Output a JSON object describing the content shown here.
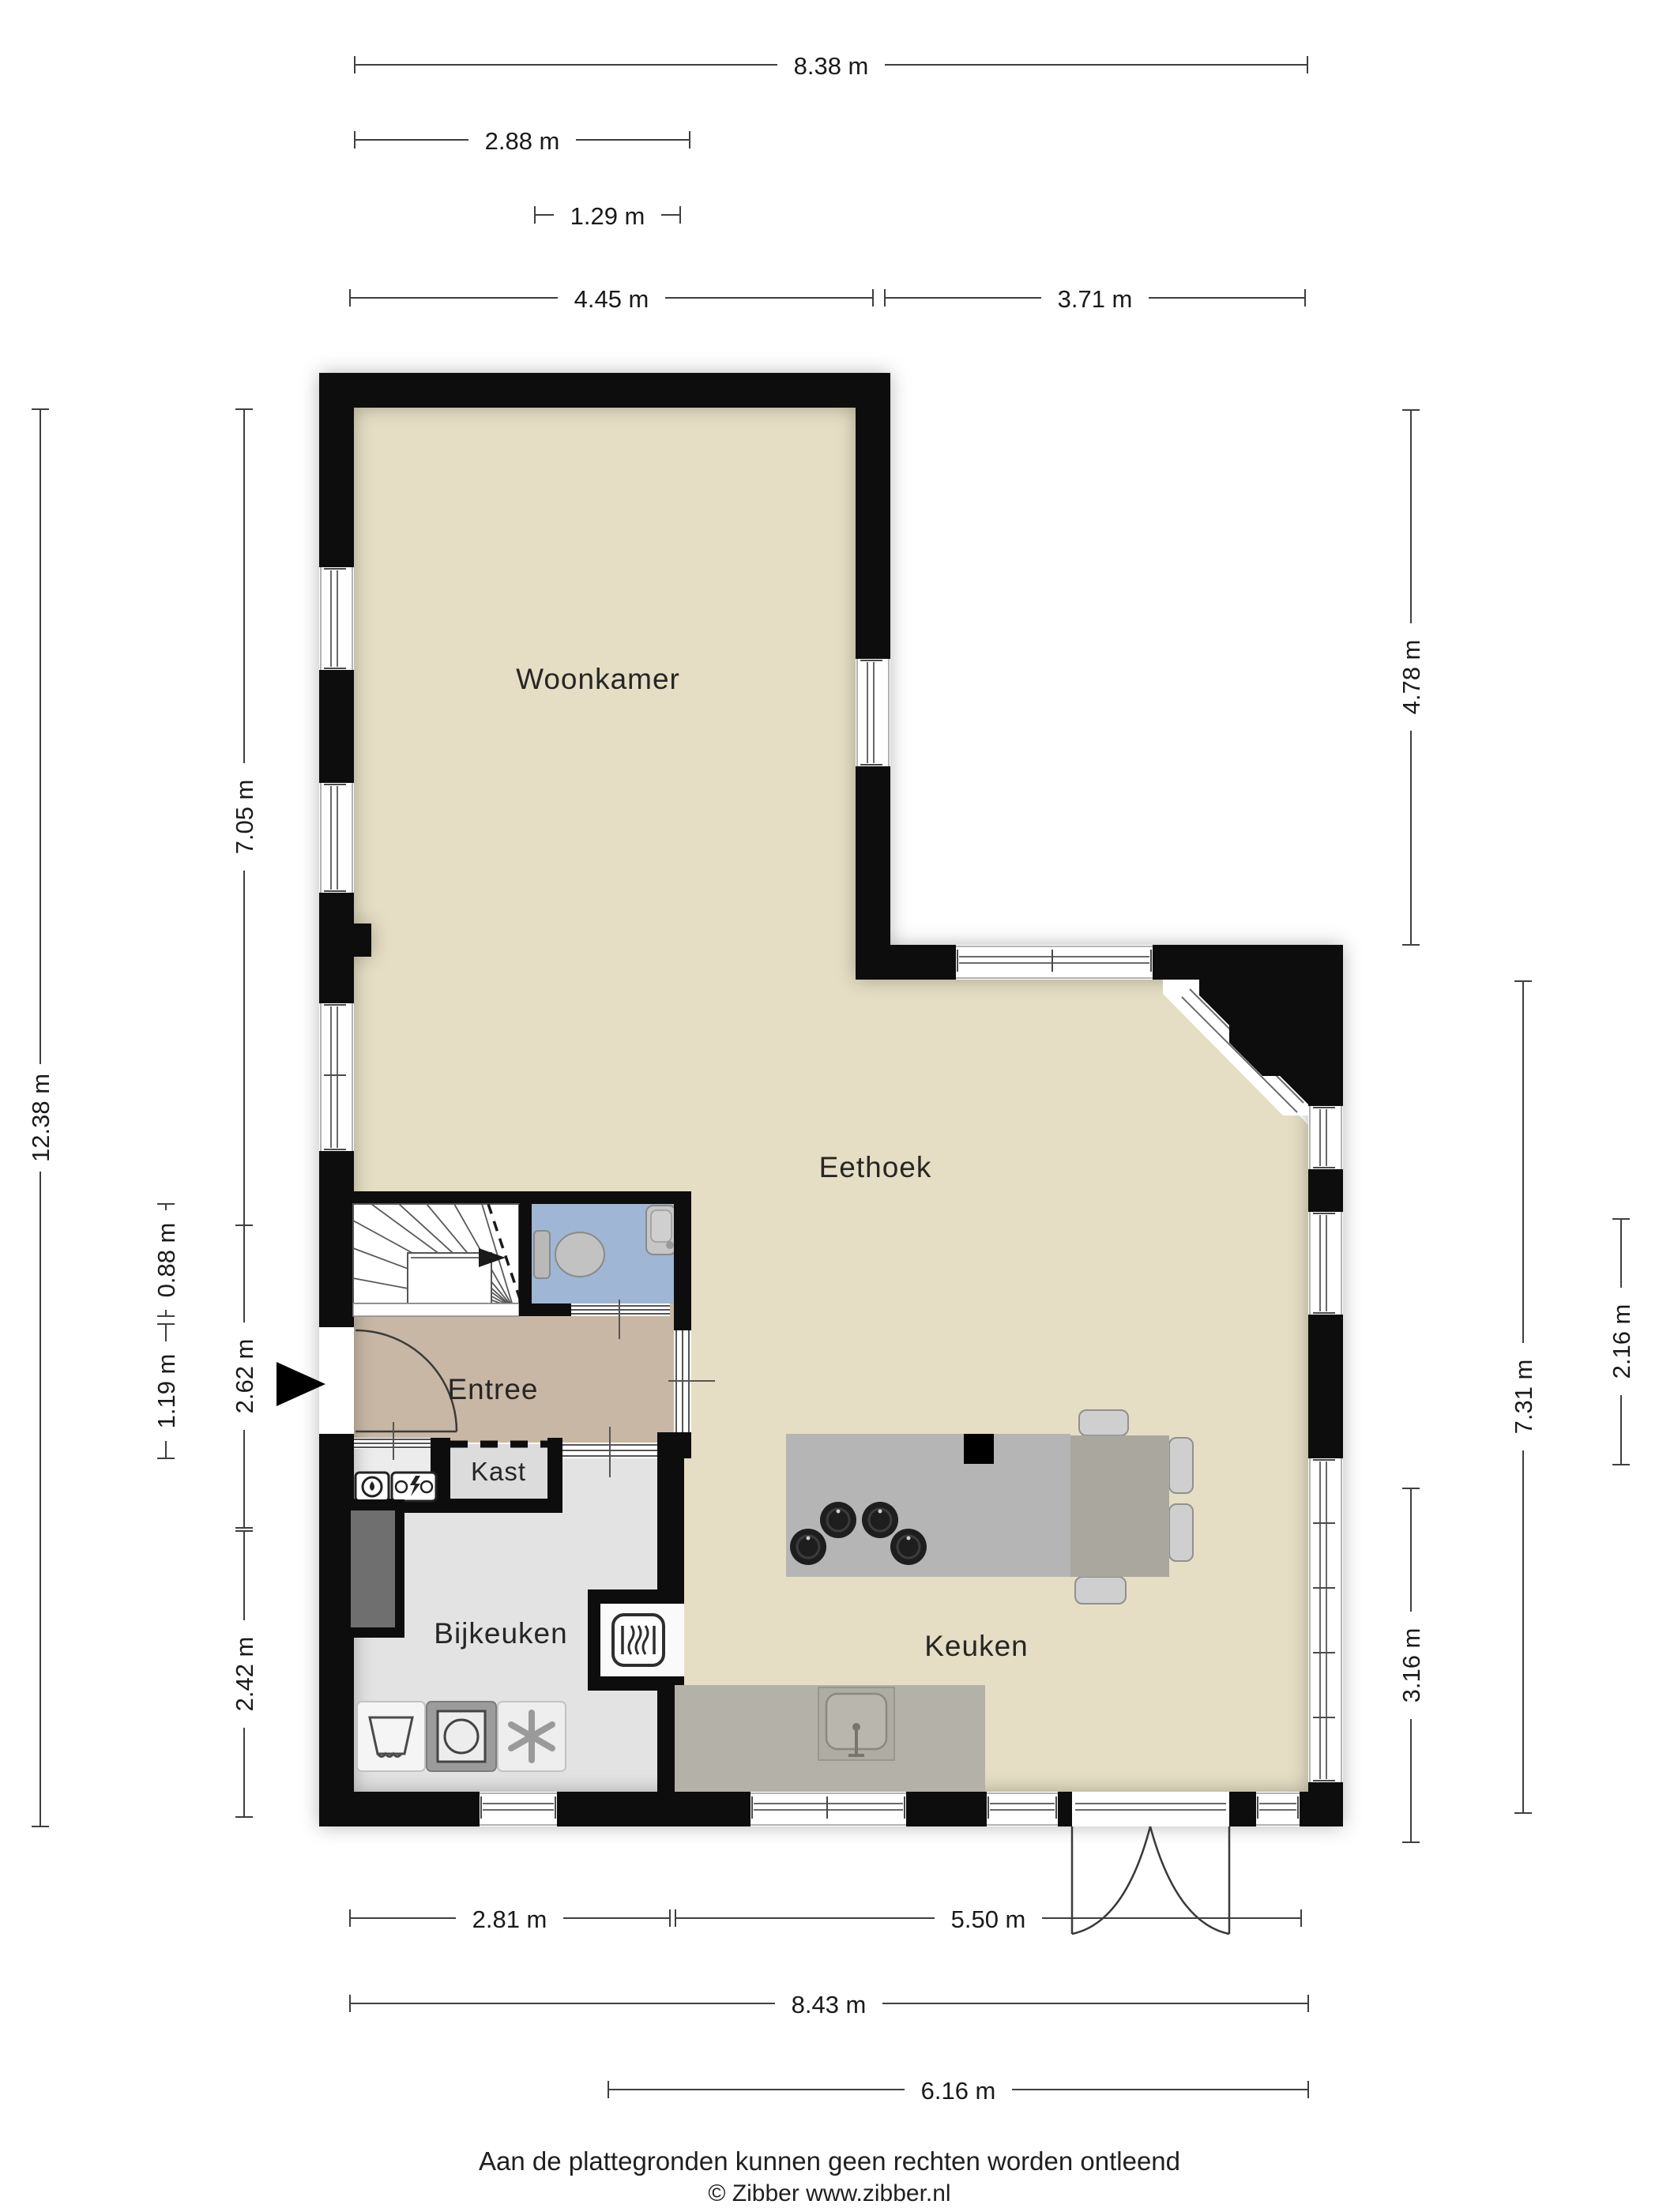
{
  "title": "Begane grond plattegrond",
  "rooms": {
    "woonkamer": {
      "label": "Woonkamer"
    },
    "eethoek": {
      "label": "Eethoek"
    },
    "entree": {
      "label": "Entree"
    },
    "kast": {
      "label": "Kast"
    },
    "bijkeuken": {
      "label": "Bijkeuken"
    },
    "keuken": {
      "label": "Keuken"
    }
  },
  "dimensions": {
    "top": [
      {
        "label": "8.38 m"
      },
      {
        "label": "2.88 m"
      },
      {
        "label": "1.29 m"
      },
      {
        "label": "4.45 m"
      },
      {
        "label": "3.71 m"
      }
    ],
    "bottom": [
      {
        "label": "2.81 m"
      },
      {
        "label": "5.50 m"
      },
      {
        "label": "8.43 m"
      },
      {
        "label": "6.16 m"
      }
    ],
    "left": [
      {
        "label": "12.38 m"
      },
      {
        "label": "7.05 m"
      },
      {
        "label": "2.62 m"
      },
      {
        "label": "2.42 m"
      },
      {
        "label": "0.88 m"
      },
      {
        "label": "1.19 m"
      }
    ],
    "right": [
      {
        "label": "4.78 m"
      },
      {
        "label": "7.31 m"
      },
      {
        "label": "2.16 m"
      },
      {
        "label": "3.16 m"
      }
    ]
  },
  "footer": {
    "line1": "Aan de plattegronden kunnen geen rechten worden ontleend",
    "line2": "© Zibber www.zibber.nl"
  },
  "icons": {
    "entrance_arrow": "solid right-pointing triangle at front door",
    "stairs_direction_arrow": "arrow showing stair run direction",
    "toilet": "toilet top view",
    "hand_basin": "small wash basin",
    "water_meter": "meter box with drop symbol",
    "electric_meter": "meter box with lightning bolt",
    "refrigerator_cabinet": "dark recessed cabinet",
    "extractor_unit": "trapezoid appliance icon",
    "washing_machine": "square with drum circle",
    "freezer_snowflake": "six-spoke asterisk",
    "central_heating_boiler": "rounded square with heat waves",
    "gas_burners": "four dark hob circles",
    "kitchen_sink": "rounded square sink with tap",
    "island_sink_block": "black square on island"
  },
  "palette": {
    "wall": "#0d0d0d",
    "floor_main": "#e5dec4",
    "floor_entree": "#c8b7a5",
    "floor_toilet": "#9fb6d4",
    "floor_utility": "#e3e3e3",
    "floor_kast": "#dcdcdc",
    "island": "#b5b5b5",
    "dining_table": "#aaa79f",
    "counter": "#b3b1a8",
    "chair": "#cfcfcf"
  }
}
